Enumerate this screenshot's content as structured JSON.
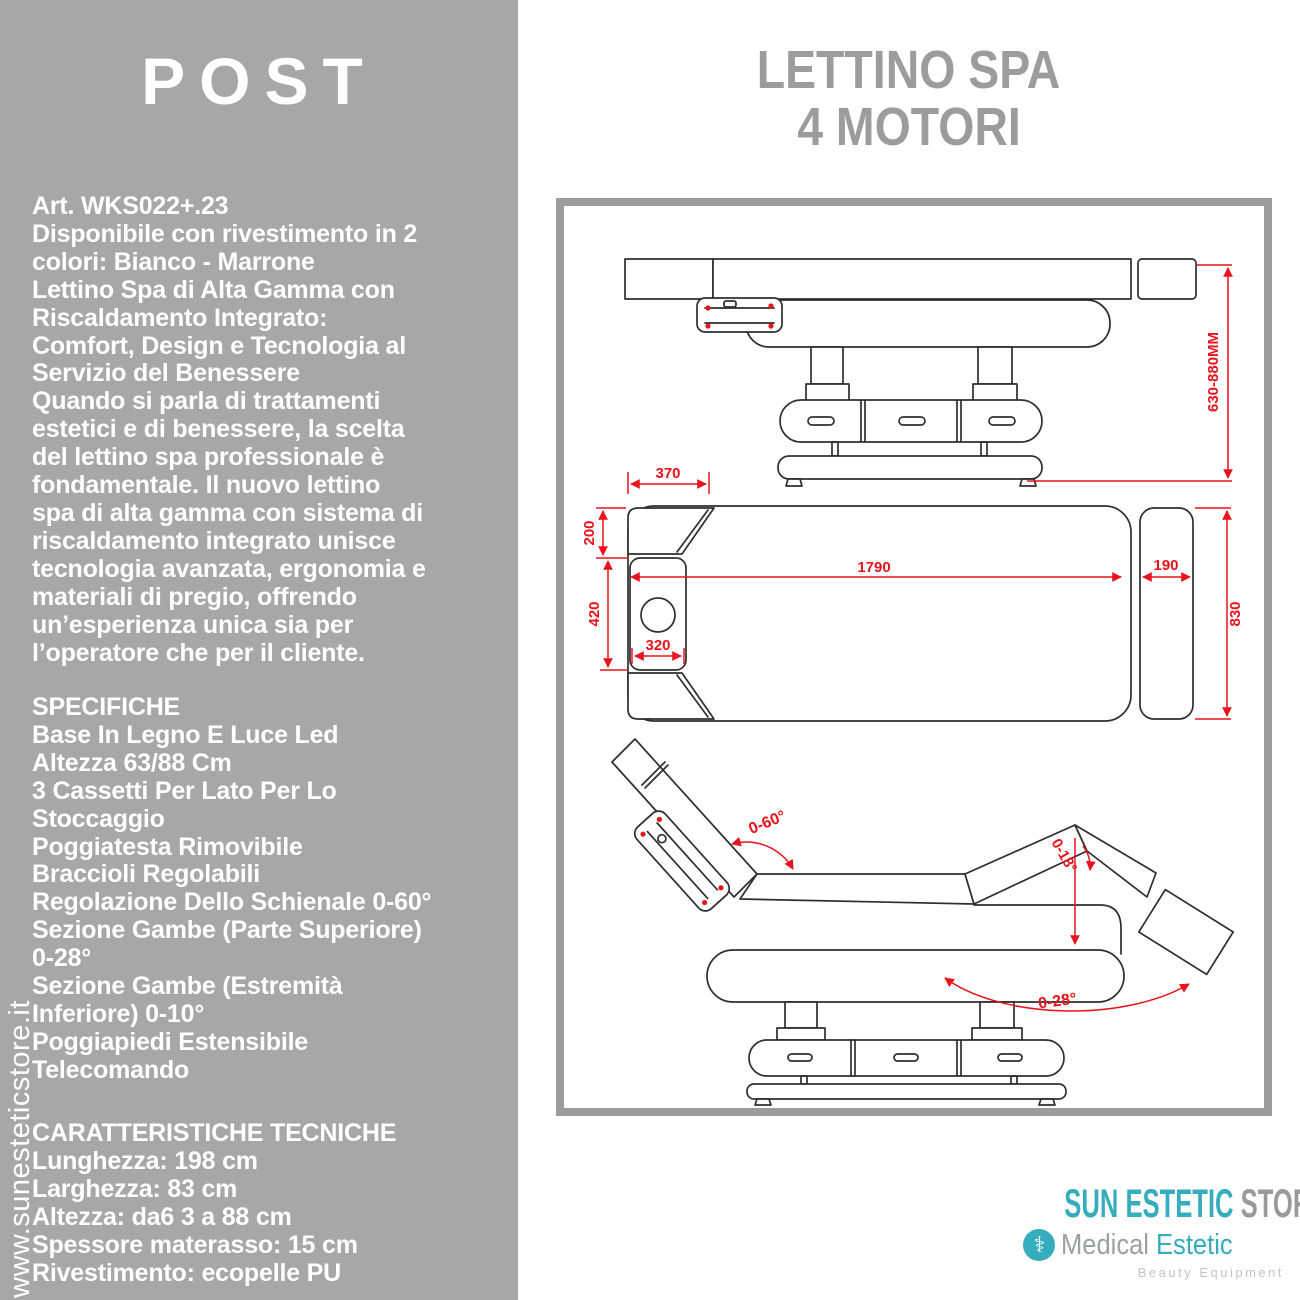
{
  "sidebar": {
    "logo": "POST",
    "watermark": "www.sunesteticstore.it",
    "description_lines": [
      "Art. WKS022+.23",
      "Disponibile con rivestimento in 2",
      "colori: Bianco - Marrone",
      "Lettino Spa di Alta Gamma con",
      "Riscaldamento Integrato:",
      "Comfort, Design e Tecnologia al",
      "Servizio del Benessere",
      "Quando si parla di trattamenti",
      "estetici e di benessere, la scelta",
      "del lettino spa professionale è",
      "fondamentale. Il nuovo lettino",
      "spa di alta gamma con sistema di",
      "riscaldamento integrato unisce",
      "tecnologia avanzata, ergonomia e",
      "materiali di pregio, offrendo",
      "un’esperienza unica sia per",
      "l’operatore che per il cliente."
    ],
    "specs_lines": [
      "SPECIFICHE",
      "Base In Legno E Luce Led",
      "Altezza 63/88 Cm",
      "3 Cassetti Per Lato Per Lo",
      "Stoccaggio",
      "Poggiatesta Rimovibile",
      "Braccioli Regolabili",
      "Regolazione Dello Schienale 0-60°",
      "Sezione Gambe (Parte Superiore)",
      "0-28°",
      "Sezione Gambe (Estremità",
      "Inferiore) 0-10°",
      "Poggiapiedi Estensibile",
      "Telecomando"
    ],
    "tech_lines": [
      "CARATTERISTICHE TECNICHE",
      "Lunghezza: 198 cm",
      "Larghezza: 83 cm",
      "Altezza: da6 3 a 88 cm",
      "Spessore materasso: 15 cm",
      "Rivestimento: ecopelle PU"
    ]
  },
  "header": {
    "title_line1": "LETTINO SPA",
    "title_line2": "4 MOTORI"
  },
  "diagram": {
    "height_range_label": "630-880MM",
    "dims": {
      "d370": "370",
      "d200": "200",
      "d420": "420",
      "d320": "320",
      "d1790": "1790",
      "d190": "190",
      "d830": "830"
    },
    "angles": {
      "backrest": "0-60°",
      "leg_upper": "0-28°",
      "leg_lower": "0-18°"
    }
  },
  "footer_logo": {
    "store_teal": "SUN ESTETIC",
    "store_gray": " STORE",
    "caduceus_icon": "⚕",
    "brand_gray": "Medical ",
    "brand_teal": "Estetic",
    "tagline": "Beauty Equipment"
  },
  "colors": {
    "sidebar_gray": "#a7a7a7",
    "title_gray": "#9c9c9c",
    "dimension_red": "#e8131c",
    "brand_teal": "#35adbd",
    "logo_gray": "#9a9a9a"
  }
}
